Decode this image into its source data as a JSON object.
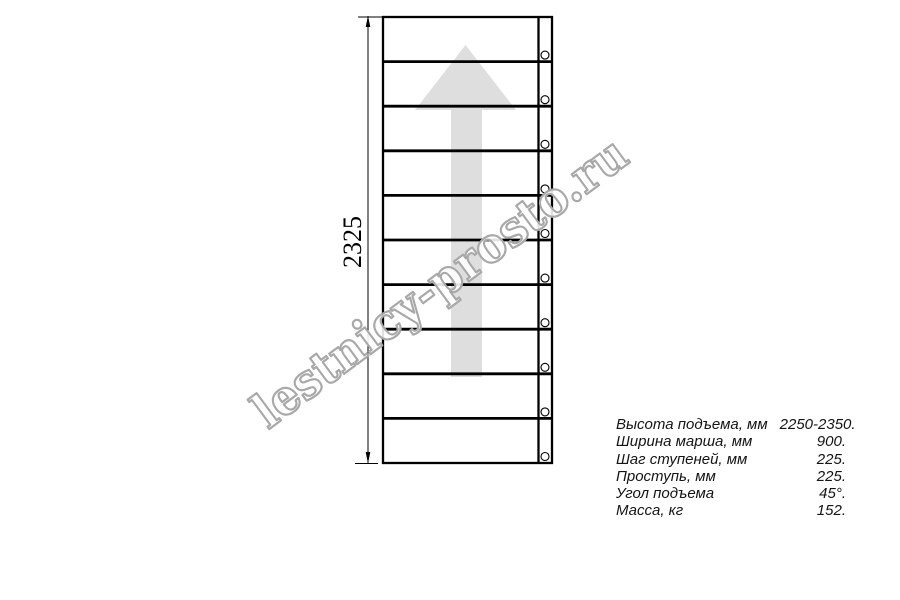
{
  "drawing": {
    "dimension_label": "2325",
    "steps_count": 10,
    "left": 383,
    "right": 552,
    "top": 17,
    "bottom": 463,
    "stringer_x": 538.5,
    "bolt_cx": 545,
    "bolt_r": 4
  },
  "watermark": {
    "text": "lestnicy-prosto.ru"
  },
  "specs": {
    "rows": [
      {
        "label": "Высота подъема, мм",
        "value": "2250-2350."
      },
      {
        "label": "Ширина марша, мм",
        "value": "900."
      },
      {
        "label": "Шаг ступеней, мм",
        "value": "225."
      },
      {
        "label": "Проступь, мм",
        "value": "225."
      },
      {
        "label": "Угол подъема",
        "value": "45°."
      },
      {
        "label": "Масса, кг",
        "value": "152."
      }
    ]
  },
  "colors": {
    "line": "#000000",
    "arrow_fill": "#dedede",
    "watermark_stroke": "#a8a8a8",
    "text": "#141414"
  }
}
